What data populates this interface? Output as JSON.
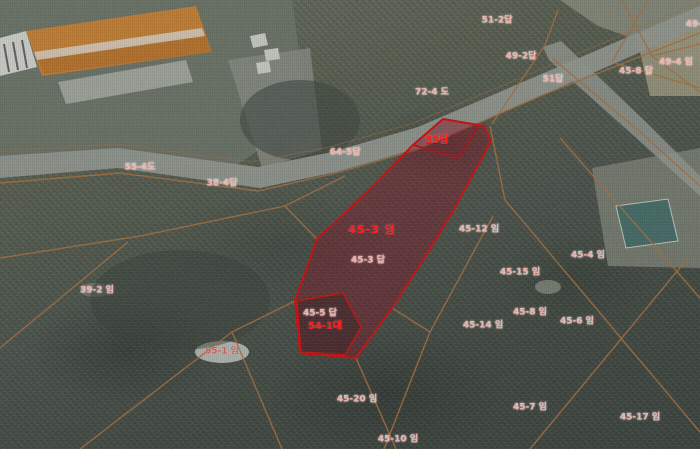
{
  "map": {
    "width": 700,
    "height": 449,
    "colors": {
      "highlight_stroke": "#e60000",
      "highlight_fill": "rgba(150,0,25,0.40)",
      "cadastral_line": "#b8743b",
      "road": "#9ca29a",
      "label_bright": "#ff2020",
      "label_pale": "#f0b0aa"
    },
    "parcels": [
      {
        "name": "parcel-53",
        "label": "53답",
        "fill": "rgba(150,0,25,0.12)",
        "strokeW": 1.8,
        "points": [
          [
            413,
            145
          ],
          [
            443,
            119
          ],
          [
            479,
            125
          ],
          [
            459,
            158
          ]
        ]
      },
      {
        "name": "parcel-45-3-highlight",
        "label": "45-3 임",
        "fill": "rgba(150,0,25,0.40)",
        "strokeW": 2,
        "points": [
          [
            413,
            145
          ],
          [
            443,
            119
          ],
          [
            484,
            126
          ],
          [
            491,
            141
          ],
          [
            452,
            213
          ],
          [
            420,
            265
          ],
          [
            392,
            308
          ],
          [
            356,
            358
          ],
          [
            300,
            353
          ],
          [
            295,
            300
          ],
          [
            317,
            239
          ],
          [
            368,
            191
          ]
        ]
      },
      {
        "name": "parcel-54-1",
        "label": "54-1대",
        "fill": "rgba(25,18,18,0.35)",
        "strokeW": 1.5,
        "points": [
          [
            297,
            301
          ],
          [
            343,
            293
          ],
          [
            361,
            327
          ],
          [
            345,
            355
          ],
          [
            301,
            352
          ]
        ]
      }
    ],
    "labels": [
      {
        "text": "51-2답",
        "x": 497,
        "y": 21,
        "style": "pale"
      },
      {
        "text": "49-2답",
        "x": 521,
        "y": 57,
        "style": "pale"
      },
      {
        "text": "51답",
        "x": 553,
        "y": 80,
        "style": "pale"
      },
      {
        "text": "49-4",
        "x": 697,
        "y": 25,
        "style": "pale"
      },
      {
        "text": "49-4 임",
        "x": 676,
        "y": 63,
        "style": "pale"
      },
      {
        "text": "45-8 답",
        "x": 636,
        "y": 72,
        "style": "pale"
      },
      {
        "text": "72-4 도",
        "x": 432,
        "y": 93,
        "style": "pale"
      },
      {
        "text": "53답",
        "x": 437,
        "y": 141,
        "style": "bright"
      },
      {
        "text": "64-5답",
        "x": 345,
        "y": 153,
        "style": "pale"
      },
      {
        "text": "55-4도",
        "x": 140,
        "y": 168,
        "style": "pale"
      },
      {
        "text": "38-4답",
        "x": 222,
        "y": 184,
        "style": "pale"
      },
      {
        "text": "45-3 임",
        "x": 372,
        "y": 230,
        "style": "bright-large"
      },
      {
        "text": "45-12 임",
        "x": 479,
        "y": 230,
        "style": "pale"
      },
      {
        "text": "45-4 임",
        "x": 588,
        "y": 256,
        "style": "pale"
      },
      {
        "text": "45-3 답",
        "x": 368,
        "y": 261,
        "style": "pale"
      },
      {
        "text": "45-15 임",
        "x": 520,
        "y": 273,
        "style": "pale"
      },
      {
        "text": "39-2 임",
        "x": 97,
        "y": 291,
        "style": "pale"
      },
      {
        "text": "45-8 임",
        "x": 530,
        "y": 313,
        "style": "pale"
      },
      {
        "text": "45-5 답",
        "x": 320,
        "y": 314,
        "style": "pale"
      },
      {
        "text": "45-6 임",
        "x": 577,
        "y": 322,
        "style": "pale"
      },
      {
        "text": "45-14 임",
        "x": 483,
        "y": 326,
        "style": "pale"
      },
      {
        "text": "54-1대",
        "x": 325,
        "y": 327,
        "style": "bright"
      },
      {
        "text": "55-1 임",
        "x": 222,
        "y": 352,
        "style": "pale-dark"
      },
      {
        "text": "45-20 임",
        "x": 357,
        "y": 400,
        "style": "pale"
      },
      {
        "text": "45-7 임",
        "x": 530,
        "y": 408,
        "style": "pale"
      },
      {
        "text": "45-17 임",
        "x": 640,
        "y": 418,
        "style": "pale"
      },
      {
        "text": "45-10 임",
        "x": 398,
        "y": 440,
        "style": "pale"
      }
    ],
    "patches": [
      {
        "name": "ground-upper-left",
        "points": [
          [
            0,
            0
          ],
          [
            292,
            0
          ],
          [
            308,
            118
          ],
          [
            232,
            168
          ],
          [
            118,
            160
          ],
          [
            0,
            172
          ]
        ],
        "fill": "#6f7a6b",
        "opacity": 0.9
      },
      {
        "name": "ground-top-right",
        "points": [
          [
            560,
            0
          ],
          [
            700,
            0
          ],
          [
            700,
            62
          ],
          [
            598,
            26
          ]
        ],
        "fill": "#8b9180",
        "opacity": 0.95
      },
      {
        "name": "field-top-right",
        "points": [
          [
            636,
            34
          ],
          [
            700,
            22
          ],
          [
            700,
            96
          ],
          [
            650,
            96
          ]
        ],
        "fill": "#a5a283",
        "opacity": 0.9
      },
      {
        "name": "clearing-right",
        "points": [
          [
            592,
            168
          ],
          [
            700,
            148
          ],
          [
            700,
            268
          ],
          [
            608,
            266
          ]
        ],
        "fill": "#7e8577",
        "opacity": 0.9
      },
      {
        "name": "yard-by-buildings",
        "points": [
          [
            228,
            60
          ],
          [
            310,
            48
          ],
          [
            322,
            150
          ],
          [
            262,
            168
          ]
        ],
        "fill": "#8d948b",
        "opacity": 0.85
      },
      {
        "name": "bare-patch",
        "ellipse": [
          222,
          352,
          27,
          11
        ],
        "fill": "#ccd1c9",
        "opacity": 0.92
      },
      {
        "name": "bare-patch",
        "ellipse": [
          548,
          287,
          13,
          7
        ],
        "fill": "#99a090",
        "opacity": 0.7
      },
      {
        "name": "bare-patch",
        "ellipse": [
          95,
          290,
          15,
          7
        ],
        "fill": "#868e80",
        "opacity": 0.6
      },
      {
        "name": "forest-dark-patch",
        "ellipse": [
          300,
          120,
          60,
          40
        ],
        "fill": "#39423a",
        "opacity": 0.6
      },
      {
        "name": "forest-dark-patch",
        "ellipse": [
          180,
          300,
          90,
          50
        ],
        "fill": "#323b33",
        "opacity": 0.5
      }
    ],
    "roads": [
      {
        "name": "road-main",
        "points": [
          [
            0,
            156
          ],
          [
            118,
            148
          ],
          [
            258,
            167
          ],
          [
            332,
            152
          ],
          [
            418,
            127
          ],
          [
            700,
            6
          ],
          [
            700,
            26
          ],
          [
            426,
            146
          ],
          [
            336,
            172
          ],
          [
            260,
            188
          ],
          [
            118,
            168
          ],
          [
            0,
            178
          ]
        ],
        "opacity": 0.95
      },
      {
        "name": "road-branch",
        "points": [
          [
            543,
            47
          ],
          [
            561,
            41
          ],
          [
            646,
            122
          ],
          [
            700,
            176
          ],
          [
            700,
            196
          ],
          [
            634,
            136
          ],
          [
            549,
            60
          ]
        ],
        "opacity": 0.85
      }
    ],
    "buildings": [
      {
        "name": "building-white",
        "points": [
          [
            0,
            38
          ],
          [
            26,
            31
          ],
          [
            37,
            67
          ],
          [
            0,
            76
          ]
        ],
        "fill": "#e6e8e2"
      },
      {
        "name": "building-orange-roof",
        "points": [
          [
            26,
            31
          ],
          [
            196,
            6
          ],
          [
            212,
            52
          ],
          [
            42,
            76
          ]
        ],
        "fill": "#d9862b"
      },
      {
        "name": "building-roof-lower-plane",
        "points": [
          [
            37,
            58
          ],
          [
            205,
            34
          ],
          [
            212,
            52
          ],
          [
            44,
            74
          ]
        ],
        "fill": "#c9751f",
        "opacity": 0.9
      },
      {
        "name": "building-roof-ridge",
        "points": [
          [
            34,
            52
          ],
          [
            202,
            28
          ],
          [
            205,
            36
          ],
          [
            37,
            60
          ]
        ],
        "fill": "#f0e8da",
        "opacity": 0.85
      },
      {
        "name": "building-gray-roof",
        "points": [
          [
            58,
            82
          ],
          [
            186,
            60
          ],
          [
            193,
            82
          ],
          [
            66,
            104
          ]
        ],
        "fill": "#b7bcb4",
        "opacity": 0.85
      },
      {
        "name": "white-structure",
        "points": [
          [
            250,
            36
          ],
          [
            265,
            33
          ],
          [
            268,
            45
          ],
          [
            253,
            48
          ]
        ],
        "fill": "#dde1da"
      },
      {
        "name": "white-structure",
        "points": [
          [
            264,
            50
          ],
          [
            278,
            48
          ],
          [
            280,
            59
          ],
          [
            266,
            61
          ]
        ],
        "fill": "#dde1da"
      },
      {
        "name": "white-structure",
        "points": [
          [
            256,
            63
          ],
          [
            269,
            61
          ],
          [
            271,
            72
          ],
          [
            258,
            74
          ]
        ],
        "fill": "#dde1da"
      },
      {
        "name": "building-teal-roof",
        "points": [
          [
            616,
            206
          ],
          [
            668,
            199
          ],
          [
            678,
            241
          ],
          [
            626,
            248
          ]
        ],
        "fill": "#40706a",
        "stroke": "#d8dcd4"
      }
    ],
    "lines": [
      {
        "pts": [
          [
            0,
            183
          ],
          [
            120,
            173
          ],
          [
            258,
            191
          ],
          [
            336,
            173
          ],
          [
            416,
            150
          ]
        ]
      },
      {
        "pts": [
          [
            416,
            150
          ],
          [
            540,
            96
          ],
          [
            700,
            33
          ]
        ]
      },
      {
        "pts": [
          [
            0,
            151
          ],
          [
            116,
            144
          ],
          [
            252,
            162
          ],
          [
            330,
            147
          ],
          [
            414,
            123
          ],
          [
            700,
            2
          ]
        ],
        "opacity": 0.5,
        "w": 1
      },
      {
        "pts": [
          [
            545,
            45
          ],
          [
            492,
            124
          ]
        ]
      },
      {
        "pts": [
          [
            558,
            10
          ],
          [
            545,
            45
          ]
        ]
      },
      {
        "pts": [
          [
            552,
            58
          ],
          [
            640,
            132
          ],
          [
            700,
            186
          ]
        ]
      },
      {
        "pts": [
          [
            622,
            0
          ],
          [
            652,
            56
          ],
          [
            700,
            92
          ]
        ]
      },
      {
        "pts": [
          [
            652,
            56
          ],
          [
            700,
            44
          ]
        ]
      },
      {
        "pts": [
          [
            0,
            258
          ],
          [
            140,
            236
          ],
          [
            285,
            206
          ]
        ]
      },
      {
        "pts": [
          [
            285,
            206
          ],
          [
            345,
            176
          ]
        ]
      },
      {
        "pts": [
          [
            285,
            206
          ],
          [
            317,
            239
          ]
        ]
      },
      {
        "pts": [
          [
            0,
            348
          ],
          [
            128,
            242
          ]
        ]
      },
      {
        "pts": [
          [
            295,
            301
          ],
          [
            232,
            332
          ]
        ]
      },
      {
        "pts": [
          [
            232,
            332
          ],
          [
            282,
            449
          ]
        ]
      },
      {
        "pts": [
          [
            232,
            332
          ],
          [
            80,
            449
          ]
        ]
      },
      {
        "pts": [
          [
            356,
            358
          ],
          [
            396,
            449
          ]
        ]
      },
      {
        "pts": [
          [
            493,
            216
          ],
          [
            430,
            332
          ],
          [
            384,
            449
          ]
        ]
      },
      {
        "pts": [
          [
            490,
            126
          ],
          [
            505,
            200
          ],
          [
            700,
            432
          ]
        ]
      },
      {
        "pts": [
          [
            560,
            138
          ],
          [
            700,
            298
          ]
        ]
      },
      {
        "pts": [
          [
            688,
            258
          ],
          [
            530,
            449
          ]
        ]
      },
      {
        "pts": [
          [
            612,
            62
          ],
          [
            648,
            0
          ]
        ]
      },
      {
        "pts": [
          [
            615,
            63
          ],
          [
            700,
            88
          ]
        ]
      },
      {
        "pts": [
          [
            392,
            308
          ],
          [
            430,
            332
          ]
        ]
      },
      {
        "pts": [
          [
            4,
            44
          ],
          [
            9,
            72
          ]
        ],
        "color": "#4f554e",
        "w": 2
      },
      {
        "pts": [
          [
            13,
            42
          ],
          [
            18,
            70
          ]
        ],
        "color": "#4f554e",
        "w": 2
      },
      {
        "pts": [
          [
            22,
            40
          ],
          [
            27,
            68
          ]
        ],
        "color": "#4f554e",
        "w": 2
      }
    ]
  }
}
